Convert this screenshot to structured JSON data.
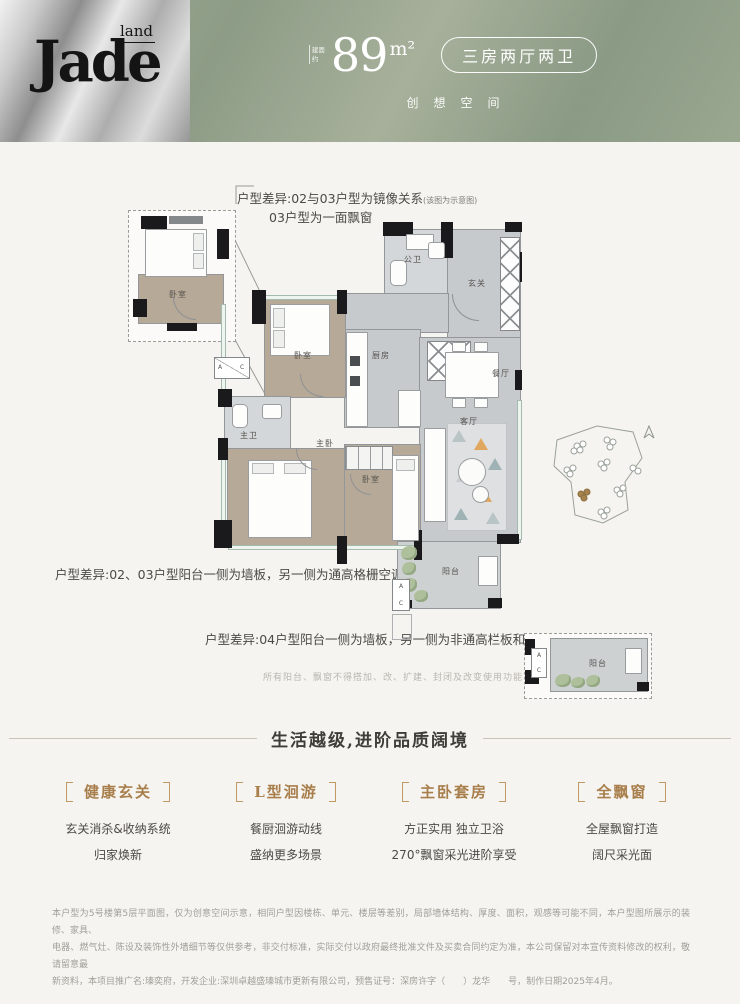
{
  "colors": {
    "header_green": "#8d9c86",
    "logo_silver": "#c9c9c9",
    "accent_gold": "#a87f4c",
    "wall_black": "#1a1a1d"
  },
  "header": {
    "logo_main": "Jade",
    "logo_sub": "land",
    "area_prefix": "建面约",
    "area_number": "89",
    "area_unit": "m²",
    "type_badge": "三房两厅两卫",
    "tagline": "创想空间"
  },
  "floorplan": {
    "annotation_top_1": "户型差异:02与03户型为镜像关系",
    "annotation_top_1_note": "(该图为示意图)",
    "annotation_top_2": "03户型为一面飘窗",
    "annotation_mid": "户型差异:02、03户型阳台一侧为墙板，另一侧为通高格栅空调机位",
    "annotation_bottom": "户型差异:04户型阳台一侧为墙板，另一侧为非通高栏板和空调位",
    "annotation_note": "所有阳台、飘窗不得搭加、改、扩建、封闭及改变使用功能",
    "rooms": {
      "inset_bedroom": "卧室",
      "public_bath": "公卫",
      "foyer": "玄关",
      "bedroom_2": "卧室",
      "kitchen": "厨房",
      "dining": "餐厅",
      "master_bath": "主卫",
      "master_bedroom": "主卧",
      "bedroom_3": "卧室",
      "living": "客厅",
      "balcony": "阳台",
      "inset_balcony": "阳台"
    },
    "ac": {
      "a": "A",
      "c": "C"
    }
  },
  "features": {
    "heading": "生活越级,进阶品质阔境",
    "items": [
      {
        "title": "健康玄关",
        "lines": [
          "玄关消杀&收纳系统",
          "归家焕新"
        ]
      },
      {
        "title": "L型洄游",
        "lines": [
          "餐厨洄游动线",
          "盛纳更多场景"
        ]
      },
      {
        "title": "主卧套房",
        "lines": [
          "方正实用 独立卫浴",
          "270°飘窗采光进阶享受"
        ]
      },
      {
        "title": "全飘窗",
        "lines": [
          "全屋飘窗打造",
          "阔尺采光面"
        ]
      }
    ]
  },
  "disclaimer": [
    "本户型为5号楼第5层平面图，仅为创意空间示意，相同户型因楼栋、单元、楼层等差别，局部墙体结构、厚度、面积，观感等可能不同，本户型图所展示的装修、家具、",
    "电器、燃气灶、陈设及装饰性外墙细节等仅供参考，非交付标准，实际交付以政府最终批准文件及买卖合同约定为准，本公司保留对本宣传资料修改的权利，敬请留意最",
    "新资料，本项目推广名:瑧奕府，开发企业:深圳卓越盛瑧城市更新有限公司，预售证号：深房许字（　　）龙华　　号，制作日期2025年4月。"
  ]
}
